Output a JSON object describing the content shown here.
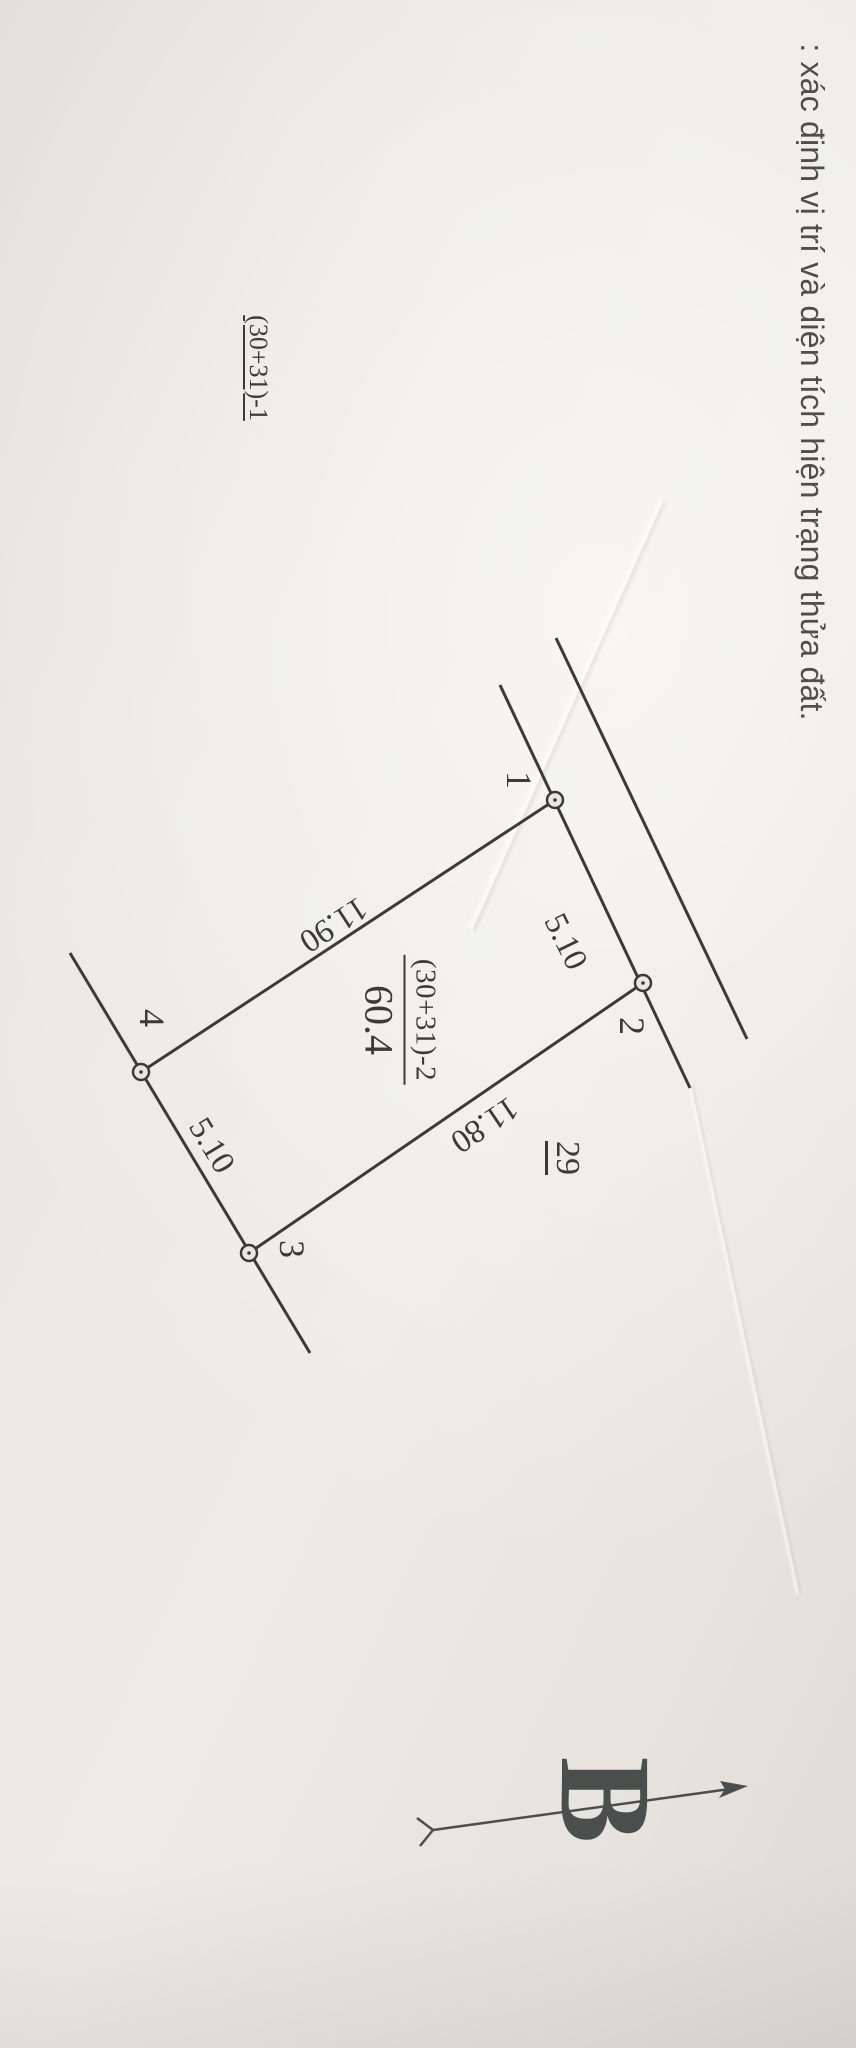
{
  "page": {
    "title": ": xác định vị trí và diện tích hiện trạng thửa đất."
  },
  "sketch": {
    "parcel": {
      "id": "(30+31)-2",
      "area": "60.4"
    },
    "neighbors": {
      "upper_left_parcel": "(30+31)-1",
      "lower_parcel": "29"
    },
    "vertices": [
      {
        "label": "1"
      },
      {
        "label": "2"
      },
      {
        "label": "3"
      },
      {
        "label": "4"
      }
    ],
    "dimensions": [
      {
        "edge": "1-2",
        "value": "5.10"
      },
      {
        "edge": "2-3",
        "value": "11.80"
      },
      {
        "edge": "4-3",
        "value": "5.10"
      },
      {
        "edge": "1-4",
        "value": "11.90"
      }
    ],
    "north": {
      "label": "B"
    }
  },
  "colors": {
    "ink": "#3a3a3a",
    "paper": "#eae7e2",
    "title_ink": "#4e4e4e"
  }
}
